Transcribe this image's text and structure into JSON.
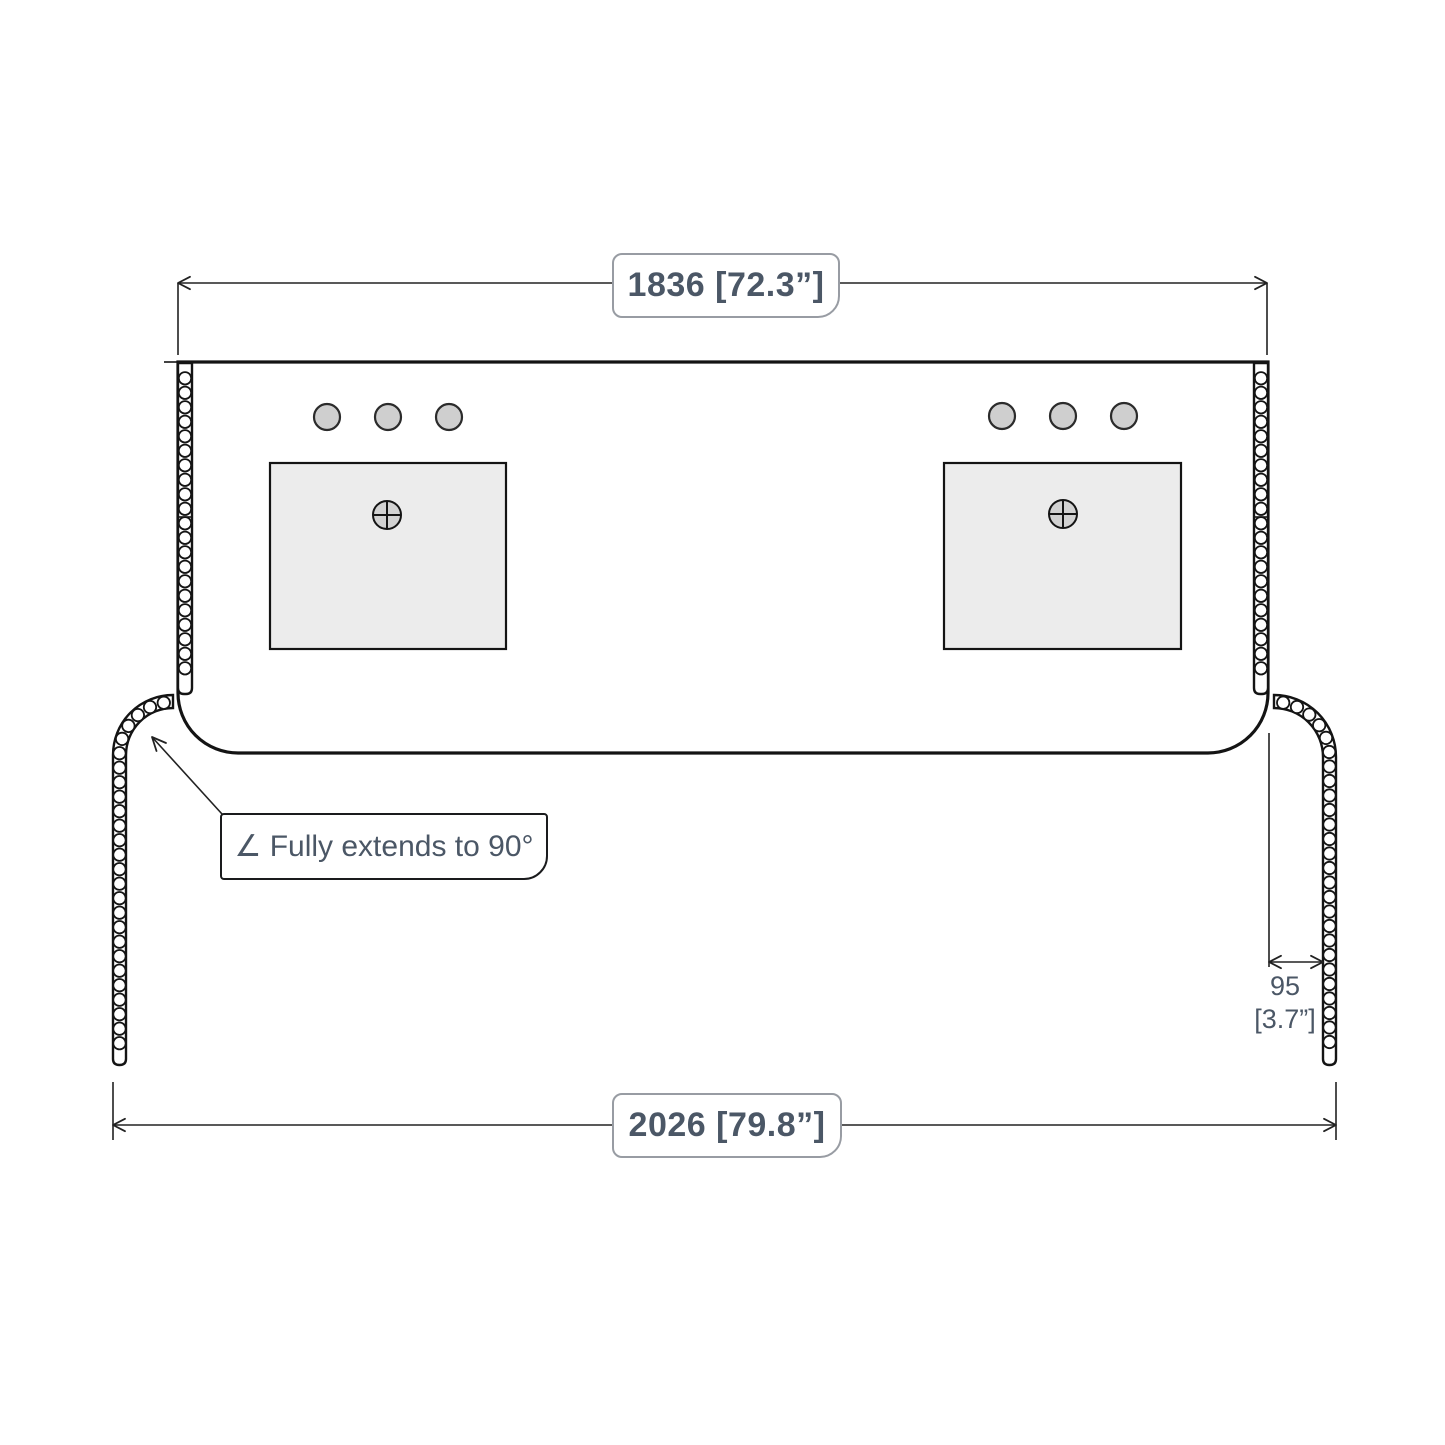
{
  "drawing": {
    "type": "vanity-countertop-dimension-diagram",
    "dimensions": {
      "top_width_label": "1836 [72.3”]",
      "bottom_width_label": "2026 [79.8”]",
      "flap_depth_value": "95",
      "flap_depth_unit": "[3.7”]"
    },
    "callout": {
      "label": "∠ Fully extends to 90°"
    },
    "colors": {
      "background": "#ffffff",
      "line": "#141414",
      "dimension_line": "#222222",
      "text": "#4b5766",
      "sink_fill": "#ececec",
      "faucet_hole_fill": "#cfcfcf",
      "drain_fill": "#d2d2d2",
      "label_box_border": "#989ca3",
      "callout_border": "#1a1b1d"
    },
    "hinge": {
      "knuckle_step": 14.5,
      "knuckle_radius": 6.2
    }
  }
}
